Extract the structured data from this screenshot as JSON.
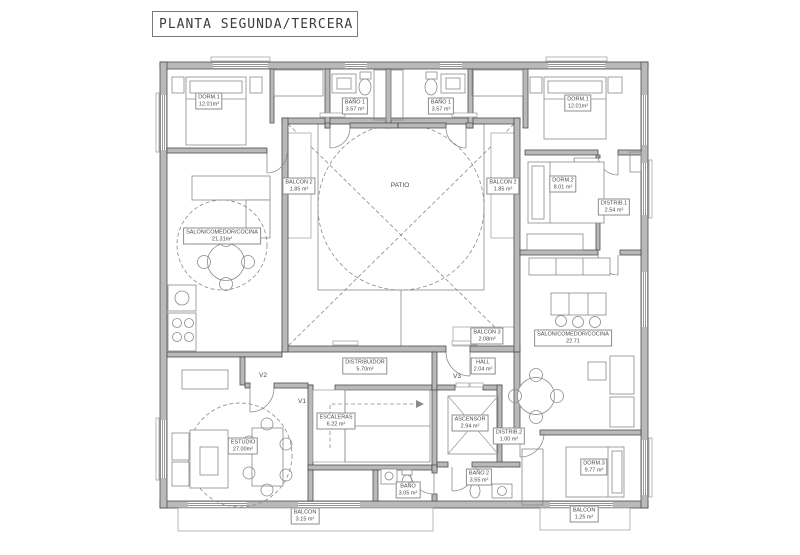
{
  "title": "PLANTA SEGUNDA/TERCERA",
  "colors": {
    "background": "#ffffff",
    "wall_fill": "#b9b9b9",
    "wall_line": "#4d4d4d",
    "furniture_line": "#8a8a8a",
    "text": "#4a4a4a"
  },
  "rooms": {
    "dorm1_left": {
      "name": "DORM.1",
      "area": "12.01m²"
    },
    "bano1_left": {
      "name": "BAÑO 1",
      "area": "3.57 m²"
    },
    "bano1_right": {
      "name": "BAÑO 1",
      "area": "3.57 m²"
    },
    "dorm1_right": {
      "name": "DORM.1",
      "area": "12.01m²"
    },
    "balcon2_left": {
      "name": "BALCON 2",
      "area": "1.85 m²"
    },
    "balcon2_right": {
      "name": "BALCON 2",
      "area": "1.85 m²"
    },
    "patio": {
      "name": "PATIO"
    },
    "salon_left": {
      "name": "SALON/COMEDOR/COCINA",
      "area": "21.31m²"
    },
    "dorm2": {
      "name": "DORM.2",
      "area": "8.01 m²"
    },
    "distrib1": {
      "name": "DISTRIB.1",
      "area": "2.54 m²"
    },
    "balcon3": {
      "name": "BALCON 3",
      "area": "2.08m²"
    },
    "salon_right": {
      "name": "SALON/COMEDOR/COCINA",
      "area": "22.71"
    },
    "distribuidor": {
      "name": "DISTRIBUIDOR",
      "area": "5.70m²"
    },
    "hall": {
      "name": "HALL",
      "area": "2.04 m²"
    },
    "escaleras": {
      "name": "ESCALERAS",
      "area": "6.22 m²"
    },
    "ascensor": {
      "name": "ASCENSOR",
      "area": "2.94 m²"
    },
    "distrib2": {
      "name": "DISTRIB.2",
      "area": "1.00 m²"
    },
    "estudio": {
      "name": "ESTUDIO",
      "area": "27.00m²"
    },
    "bano_pb": {
      "name": "BAÑO",
      "area": "3.05 m²"
    },
    "bano2": {
      "name": "BAÑO 2",
      "area": "3.55 m²"
    },
    "dorm3": {
      "name": "DORM.3",
      "area": "9.77 m²"
    },
    "balcon_bottom_left": {
      "name": "BALCON",
      "area": "3.15 m²"
    },
    "balcon_bottom_right": {
      "name": "BALCON",
      "area": "1.25 m²"
    },
    "v1": {
      "name": "V1"
    },
    "v2": {
      "name": "V2"
    },
    "v3": {
      "name": "V3"
    }
  }
}
